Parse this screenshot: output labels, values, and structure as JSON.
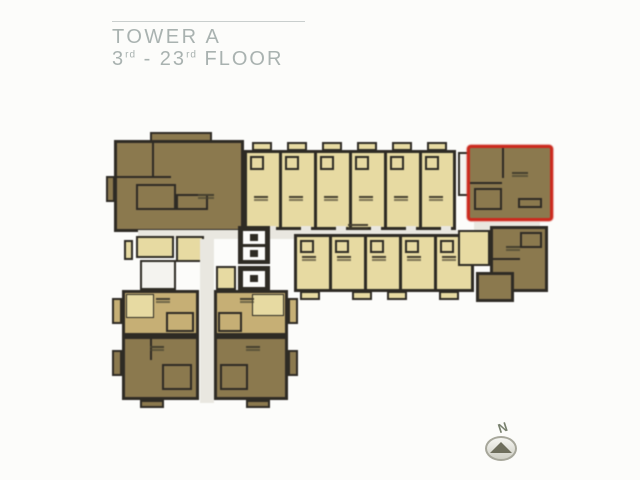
{
  "title": {
    "line1": "TOWER A",
    "line2": [
      {
        "t": "3"
      },
      {
        "t": "rd"
      },
      {
        "t": " - 23"
      },
      {
        "t": "rd"
      },
      {
        "t": " FLOOR"
      }
    ]
  },
  "compass": {
    "label": "N"
  },
  "palette": {
    "paper": "#fcfcfa",
    "cream": "#e8da9f",
    "tan": "#c7af72",
    "dark": "#8c794c",
    "wall": "#2e2b24",
    "corridor": "#e9e7e0",
    "stair": "#f4f3ef",
    "red": "#d2281c",
    "title_text": "#a9b2b0",
    "title_line": "#c9cecd"
  },
  "floorplan": {
    "highlighted_unit": "top-right corner unit outlined in red",
    "rects": [
      {
        "n": "unit-a-body",
        "x": 114,
        "y": 140,
        "w": 130,
        "h": 92,
        "f": "dark",
        "bw": 3
      },
      {
        "n": "unit-a-top-block",
        "x": 150,
        "y": 132,
        "w": 62,
        "h": 10,
        "f": "dark",
        "bw": 2
      },
      {
        "n": "unit-a-partition-v",
        "x": 152,
        "y": 143,
        "w": 2,
        "h": 34,
        "f": "wall"
      },
      {
        "n": "unit-a-partition-h",
        "x": 117,
        "y": 176,
        "w": 54,
        "h": 2,
        "f": "wall"
      },
      {
        "n": "unit-a-bath",
        "x": 136,
        "y": 184,
        "w": 40,
        "h": 26,
        "f": "dark",
        "bw": 2
      },
      {
        "n": "unit-a-bath-2",
        "x": 176,
        "y": 194,
        "w": 32,
        "h": 16,
        "f": "dark",
        "bw": 2
      },
      {
        "n": "unit-a-balcony",
        "x": 106,
        "y": 176,
        "w": 9,
        "h": 26,
        "f": "dark",
        "bw": 2
      },
      {
        "n": "unit-a-label-mark",
        "x": 198,
        "y": 194,
        "w": 16,
        "h": 2,
        "cls": "label-mark"
      },
      {
        "n": "top-row-body",
        "x": 244,
        "y": 150,
        "w": 212,
        "h": 80,
        "f": "cream",
        "bw": 3
      },
      {
        "n": "top-row-divider",
        "x": 279,
        "y": 150,
        "w": 3,
        "h": 80,
        "f": "wall"
      },
      {
        "n": "top-row-divider",
        "x": 314,
        "y": 150,
        "w": 3,
        "h": 80,
        "f": "wall"
      },
      {
        "n": "top-row-divider",
        "x": 349,
        "y": 150,
        "w": 3,
        "h": 80,
        "f": "wall"
      },
      {
        "n": "top-row-divider",
        "x": 384,
        "y": 150,
        "w": 3,
        "h": 80,
        "f": "wall"
      },
      {
        "n": "top-row-divider",
        "x": 419,
        "y": 150,
        "w": 3,
        "h": 80,
        "f": "wall"
      },
      {
        "n": "balcony",
        "x": 252,
        "y": 142,
        "w": 20,
        "h": 9,
        "f": "cream",
        "bw": 2
      },
      {
        "n": "balcony",
        "x": 287,
        "y": 142,
        "w": 20,
        "h": 9,
        "f": "cream",
        "bw": 2
      },
      {
        "n": "balcony",
        "x": 322,
        "y": 142,
        "w": 20,
        "h": 9,
        "f": "cream",
        "bw": 2
      },
      {
        "n": "balcony",
        "x": 357,
        "y": 142,
        "w": 20,
        "h": 9,
        "f": "cream",
        "bw": 2
      },
      {
        "n": "balcony",
        "x": 392,
        "y": 142,
        "w": 20,
        "h": 9,
        "f": "cream",
        "bw": 2
      },
      {
        "n": "balcony",
        "x": 427,
        "y": 142,
        "w": 20,
        "h": 9,
        "f": "cream",
        "bw": 2
      },
      {
        "n": "unit-bath",
        "x": 250,
        "y": 156,
        "w": 14,
        "h": 14,
        "f": "cream",
        "bw": 2
      },
      {
        "n": "unit-bath",
        "x": 285,
        "y": 156,
        "w": 14,
        "h": 14,
        "f": "cream",
        "bw": 2
      },
      {
        "n": "unit-bath",
        "x": 320,
        "y": 156,
        "w": 14,
        "h": 14,
        "f": "cream",
        "bw": 2
      },
      {
        "n": "unit-bath",
        "x": 355,
        "y": 156,
        "w": 14,
        "h": 14,
        "f": "cream",
        "bw": 2
      },
      {
        "n": "unit-bath",
        "x": 390,
        "y": 156,
        "w": 14,
        "h": 14,
        "f": "cream",
        "bw": 2
      },
      {
        "n": "unit-bath",
        "x": 425,
        "y": 156,
        "w": 14,
        "h": 14,
        "f": "cream",
        "bw": 2
      },
      {
        "n": "unit-label-mark",
        "x": 254,
        "y": 196,
        "w": 14,
        "h": 2,
        "cls": "label-mark"
      },
      {
        "n": "unit-label-mark",
        "x": 289,
        "y": 196,
        "w": 14,
        "h": 2,
        "cls": "label-mark"
      },
      {
        "n": "unit-label-mark",
        "x": 324,
        "y": 196,
        "w": 14,
        "h": 2,
        "cls": "label-mark"
      },
      {
        "n": "unit-label-mark",
        "x": 359,
        "y": 196,
        "w": 14,
        "h": 2,
        "cls": "label-mark"
      },
      {
        "n": "unit-label-mark",
        "x": 394,
        "y": 196,
        "w": 14,
        "h": 2,
        "cls": "label-mark"
      },
      {
        "n": "unit-label-mark",
        "x": 429,
        "y": 196,
        "w": 14,
        "h": 2,
        "cls": "label-mark"
      },
      {
        "n": "door-notch",
        "x": 266,
        "y": 226,
        "w": 10,
        "h": 6,
        "f": "corridor"
      },
      {
        "n": "door-notch",
        "x": 301,
        "y": 226,
        "w": 10,
        "h": 6,
        "f": "corridor"
      },
      {
        "n": "door-notch",
        "x": 336,
        "y": 226,
        "w": 10,
        "h": 6,
        "f": "corridor"
      },
      {
        "n": "door-notch",
        "x": 371,
        "y": 226,
        "w": 10,
        "h": 6,
        "f": "corridor"
      },
      {
        "n": "door-notch",
        "x": 406,
        "y": 226,
        "w": 10,
        "h": 6,
        "f": "corridor"
      },
      {
        "n": "door-notch",
        "x": 441,
        "y": 226,
        "w": 10,
        "h": 6,
        "f": "corridor"
      },
      {
        "n": "stairs-top",
        "x": 458,
        "y": 152,
        "w": 12,
        "h": 44,
        "f": "stair",
        "bw": 2,
        "cls": "hatch-h"
      },
      {
        "n": "highlighted-unit",
        "x": 467,
        "y": 145,
        "w": 86,
        "h": 76,
        "f": "dark",
        "bw": 3,
        "bc": "red",
        "cls": "highlight"
      },
      {
        "n": "highlighted-unit-partition-v",
        "x": 502,
        "y": 148,
        "w": 2,
        "h": 30,
        "f": "wall"
      },
      {
        "n": "highlighted-unit-partition-h",
        "x": 470,
        "y": 182,
        "w": 32,
        "h": 2,
        "f": "wall"
      },
      {
        "n": "highlighted-unit-bath",
        "x": 474,
        "y": 188,
        "w": 28,
        "h": 22,
        "f": "dark",
        "bw": 2
      },
      {
        "n": "highlighted-unit-closet",
        "x": 518,
        "y": 198,
        "w": 24,
        "h": 10,
        "f": "dark",
        "bw": 2
      },
      {
        "n": "highlighted-unit-label-mark",
        "x": 512,
        "y": 172,
        "w": 16,
        "h": 2,
        "cls": "label-mark"
      },
      {
        "n": "corridor-top",
        "x": 138,
        "y": 230,
        "w": 344,
        "h": 9,
        "f": "corridor"
      },
      {
        "n": "corridor-label-mark",
        "x": 348,
        "y": 224,
        "w": 20,
        "h": 2,
        "cls": "label-mark"
      },
      {
        "n": "corridor-bridge",
        "x": 474,
        "y": 222,
        "w": 66,
        "h": 8,
        "f": "corridor"
      },
      {
        "n": "core-room",
        "x": 136,
        "y": 236,
        "w": 38,
        "h": 22,
        "f": "cream",
        "bw": 2
      },
      {
        "n": "core-room",
        "x": 176,
        "y": 236,
        "w": 28,
        "h": 26,
        "f": "cream",
        "bw": 2
      },
      {
        "n": "core-balcony",
        "x": 124,
        "y": 240,
        "w": 9,
        "h": 20,
        "f": "cream",
        "bw": 2
      },
      {
        "n": "stairs-core",
        "x": 140,
        "y": 260,
        "w": 36,
        "h": 30,
        "f": "stair",
        "bw": 2,
        "cls": "hatch-h"
      },
      {
        "n": "elevator-bank",
        "x": 238,
        "y": 226,
        "w": 32,
        "h": 38,
        "f": "wall"
      },
      {
        "n": "elevator-cabin",
        "x": 243,
        "y": 231,
        "w": 22,
        "h": 13,
        "f": "paper"
      },
      {
        "n": "elevator-car",
        "x": 250,
        "y": 234,
        "w": 8,
        "h": 7,
        "f": "wall"
      },
      {
        "n": "elevator-cabin",
        "x": 243,
        "y": 247,
        "w": 22,
        "h": 13,
        "f": "paper"
      },
      {
        "n": "elevator-car",
        "x": 250,
        "y": 250,
        "w": 8,
        "h": 7,
        "f": "wall"
      },
      {
        "n": "elevator-bank",
        "x": 238,
        "y": 266,
        "w": 32,
        "h": 26,
        "f": "wall"
      },
      {
        "n": "elevator-cabin",
        "x": 243,
        "y": 271,
        "w": 22,
        "h": 16,
        "f": "paper"
      },
      {
        "n": "elevator-car",
        "x": 250,
        "y": 275,
        "w": 8,
        "h": 7,
        "f": "wall"
      },
      {
        "n": "service-room",
        "x": 216,
        "y": 266,
        "w": 20,
        "h": 24,
        "f": "cream",
        "bw": 2
      },
      {
        "n": "corridor-vertical",
        "x": 200,
        "y": 239,
        "w": 14,
        "h": 164,
        "f": "corridor"
      },
      {
        "n": "mid-row-body",
        "x": 294,
        "y": 234,
        "w": 180,
        "h": 58,
        "f": "cream",
        "bw": 3
      },
      {
        "n": "mid-row-divider",
        "x": 329,
        "y": 234,
        "w": 3,
        "h": 58,
        "f": "wall"
      },
      {
        "n": "mid-row-divider",
        "x": 364,
        "y": 234,
        "w": 3,
        "h": 58,
        "f": "wall"
      },
      {
        "n": "mid-row-divider",
        "x": 399,
        "y": 234,
        "w": 3,
        "h": 58,
        "f": "wall"
      },
      {
        "n": "mid-row-divider",
        "x": 434,
        "y": 234,
        "w": 3,
        "h": 58,
        "f": "wall"
      },
      {
        "n": "unit-bath",
        "x": 300,
        "y": 240,
        "w": 14,
        "h": 13,
        "f": "cream",
        "bw": 2
      },
      {
        "n": "unit-bath",
        "x": 335,
        "y": 240,
        "w": 14,
        "h": 13,
        "f": "cream",
        "bw": 2
      },
      {
        "n": "unit-bath",
        "x": 370,
        "y": 240,
        "w": 14,
        "h": 13,
        "f": "cream",
        "bw": 2
      },
      {
        "n": "unit-bath",
        "x": 405,
        "y": 240,
        "w": 14,
        "h": 13,
        "f": "cream",
        "bw": 2
      },
      {
        "n": "unit-bath",
        "x": 440,
        "y": 240,
        "w": 14,
        "h": 13,
        "f": "cream",
        "bw": 2
      },
      {
        "n": "unit-label-mark",
        "x": 302,
        "y": 256,
        "w": 14,
        "h": 2,
        "cls": "label-mark"
      },
      {
        "n": "unit-label-mark",
        "x": 337,
        "y": 256,
        "w": 14,
        "h": 2,
        "cls": "label-mark"
      },
      {
        "n": "unit-label-mark",
        "x": 372,
        "y": 256,
        "w": 14,
        "h": 2,
        "cls": "label-mark"
      },
      {
        "n": "unit-label-mark",
        "x": 407,
        "y": 256,
        "w": 14,
        "h": 2,
        "cls": "label-mark"
      },
      {
        "n": "unit-label-mark",
        "x": 442,
        "y": 256,
        "w": 14,
        "h": 2,
        "cls": "label-mark"
      },
      {
        "n": "balcony",
        "x": 300,
        "y": 291,
        "w": 20,
        "h": 9,
        "f": "cream",
        "bw": 2
      },
      {
        "n": "balcony",
        "x": 352,
        "y": 291,
        "w": 20,
        "h": 9,
        "f": "cream",
        "bw": 2
      },
      {
        "n": "balcony",
        "x": 387,
        "y": 291,
        "w": 20,
        "h": 9,
        "f": "cream",
        "bw": 2
      },
      {
        "n": "balcony",
        "x": 439,
        "y": 291,
        "w": 20,
        "h": 9,
        "f": "cream",
        "bw": 2
      },
      {
        "n": "end-room",
        "x": 458,
        "y": 230,
        "w": 32,
        "h": 36,
        "f": "cream",
        "bw": 2
      },
      {
        "n": "end-unit-main",
        "x": 490,
        "y": 226,
        "w": 58,
        "h": 66,
        "f": "dark",
        "bw": 3
      },
      {
        "n": "end-unit-annex",
        "x": 476,
        "y": 272,
        "w": 38,
        "h": 30,
        "f": "dark",
        "bw": 3
      },
      {
        "n": "end-unit-partition",
        "x": 492,
        "y": 258,
        "w": 28,
        "h": 2,
        "f": "wall"
      },
      {
        "n": "end-unit-bath",
        "x": 520,
        "y": 232,
        "w": 22,
        "h": 16,
        "f": "dark",
        "bw": 2
      },
      {
        "n": "end-unit-label-mark",
        "x": 506,
        "y": 246,
        "w": 14,
        "h": 2,
        "cls": "label-mark"
      },
      {
        "n": "bottom-r1-left-unit",
        "x": 122,
        "y": 290,
        "w": 77,
        "h": 46,
        "f": "tan",
        "bw": 3
      },
      {
        "n": "bottom-r1-left-room",
        "x": 126,
        "y": 294,
        "w": 28,
        "h": 24,
        "f": "cream",
        "bw": 1
      },
      {
        "n": "bottom-r1-left-bath",
        "x": 166,
        "y": 312,
        "w": 28,
        "h": 20,
        "f": "tan",
        "bw": 2
      },
      {
        "n": "unit-label-mark",
        "x": 156,
        "y": 298,
        "w": 14,
        "h": 2,
        "cls": "label-mark"
      },
      {
        "n": "bottom-r1-right-unit",
        "x": 214,
        "y": 290,
        "w": 74,
        "h": 46,
        "f": "tan",
        "bw": 3
      },
      {
        "n": "bottom-r1-right-room",
        "x": 252,
        "y": 294,
        "w": 32,
        "h": 22,
        "f": "cream",
        "bw": 1
      },
      {
        "n": "bottom-r1-right-bath",
        "x": 218,
        "y": 312,
        "w": 24,
        "h": 20,
        "f": "tan",
        "bw": 2
      },
      {
        "n": "unit-label-mark",
        "x": 240,
        "y": 298,
        "w": 14,
        "h": 2,
        "cls": "label-mark"
      },
      {
        "n": "bottom-r2-left-unit",
        "x": 122,
        "y": 336,
        "w": 77,
        "h": 64,
        "f": "dark",
        "bw": 3
      },
      {
        "n": "bottom-r2-left-bath",
        "x": 162,
        "y": 364,
        "w": 30,
        "h": 26,
        "f": "dark",
        "bw": 2
      },
      {
        "n": "bottom-r2-left-partition",
        "x": 150,
        "y": 338,
        "w": 2,
        "h": 22,
        "f": "wall"
      },
      {
        "n": "unit-label-mark",
        "x": 150,
        "y": 346,
        "w": 14,
        "h": 2,
        "cls": "label-mark"
      },
      {
        "n": "bottom-r2-right-unit",
        "x": 214,
        "y": 336,
        "w": 74,
        "h": 64,
        "f": "dark",
        "bw": 3
      },
      {
        "n": "bottom-r2-right-bath",
        "x": 220,
        "y": 364,
        "w": 28,
        "h": 26,
        "f": "dark",
        "bw": 2
      },
      {
        "n": "unit-label-mark",
        "x": 246,
        "y": 346,
        "w": 14,
        "h": 2,
        "cls": "label-mark"
      },
      {
        "n": "balcony",
        "x": 112,
        "y": 298,
        "w": 10,
        "h": 26,
        "f": "tan",
        "bw": 2
      },
      {
        "n": "balcony",
        "x": 112,
        "y": 350,
        "w": 10,
        "h": 26,
        "f": "dark",
        "bw": 2
      },
      {
        "n": "balcony",
        "x": 288,
        "y": 298,
        "w": 10,
        "h": 26,
        "f": "tan",
        "bw": 2
      },
      {
        "n": "balcony",
        "x": 288,
        "y": 350,
        "w": 10,
        "h": 26,
        "f": "dark",
        "bw": 2
      },
      {
        "n": "balcony",
        "x": 140,
        "y": 400,
        "w": 24,
        "h": 8,
        "f": "dark",
        "bw": 2
      },
      {
        "n": "balcony",
        "x": 246,
        "y": 400,
        "w": 24,
        "h": 8,
        "f": "dark",
        "bw": 2
      }
    ]
  }
}
